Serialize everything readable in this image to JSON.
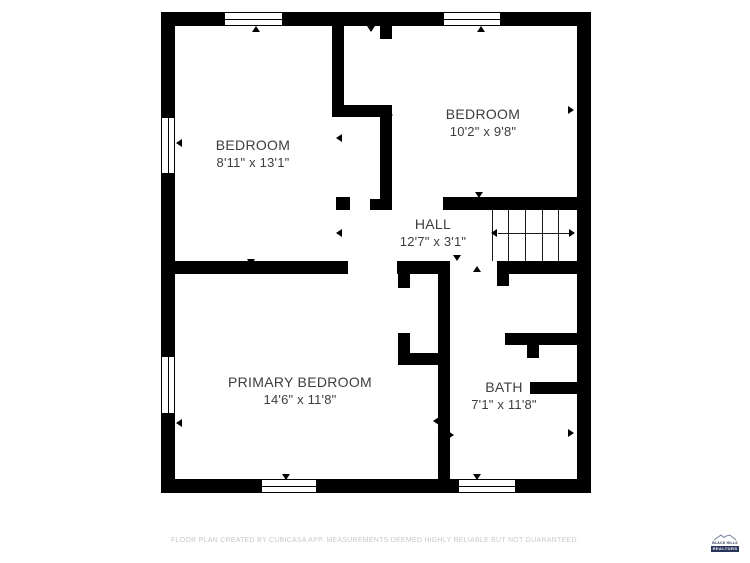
{
  "rooms": [
    {
      "id": "bedroom-1",
      "name": "BEDROOM",
      "dims": "8'11\" x 13'1\""
    },
    {
      "id": "bedroom-2",
      "name": "BEDROOM",
      "dims": "10'2\" x 9'8\""
    },
    {
      "id": "hall",
      "name": "HALL",
      "dims": "12'7\" x 3'1\""
    },
    {
      "id": "primary-bedroom",
      "name": "PRIMARY BEDROOM",
      "dims": "14'6\" x 11'8\""
    },
    {
      "id": "bath",
      "name": "BATH",
      "dims": "7'1\" x 11'8\""
    }
  ],
  "stairs": {
    "tread_count": 5,
    "direction": "left"
  },
  "footer": {
    "disclaimer": "FLOOR PLAN CREATED BY CUBICASA APP. MEASUREMENTS DEEMED HIGHLY RELIABLE BUT NOT GUARANTEED."
  },
  "logo": {
    "line1": "BLACK HILLS",
    "line2": "REALTORS"
  },
  "colors": {
    "wall": "#000000",
    "label_text": "#3d3d3d",
    "footer_text": "#c9c9c9",
    "logo_navy": "#27355c",
    "background": "#ffffff"
  }
}
